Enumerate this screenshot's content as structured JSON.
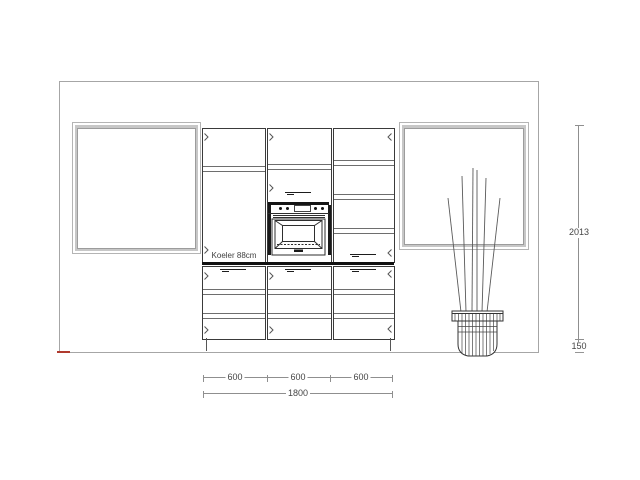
{
  "drawing": {
    "fridge_label": "Koeler 88cm",
    "dimensions": {
      "segments": [
        "600",
        "600",
        "600"
      ],
      "total_width": "1800",
      "right_height": "2013",
      "right_plinth": "150"
    },
    "colors": {
      "line": "#3a3a3a",
      "thick_line": "#111111",
      "light_line": "#a6a6a6",
      "dim_line": "#8f8f8f",
      "dim_text": "#454545",
      "accent_red": "#b03a2e"
    }
  }
}
